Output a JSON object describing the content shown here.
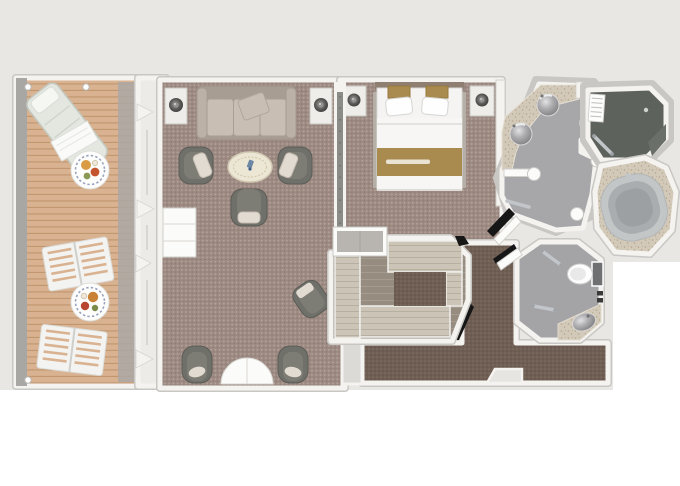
{
  "app": {
    "kind": "suite-floor-plan-rendering",
    "orientation": "top-down"
  },
  "colors": {
    "paper": "#ffffff",
    "bg": "#e8e7e4",
    "wall": "#f4f3f0",
    "wallEdge": "#c8c7c4",
    "deck": "#d9b391",
    "deckLine": "#c0976f",
    "deckRail": "#a9a7a4",
    "glass": "#edebe8",
    "carpet": "#9d8a82",
    "carpetDot": "#b5a49d",
    "carpetDark": "#8b7870",
    "hallCarpet": "#6f5e53",
    "hallDot": "#7f6e62",
    "hallDark": "#5f4f45",
    "woodShelf": "#cbc4b7",
    "woodLine": "#b7afa0",
    "closetFloor": "#968c80",
    "closetFloorLine": "#a59b8e",
    "sofa": "#bcb1a7",
    "sofaDark": "#a89d92",
    "cushion": "#c9beb4",
    "chair": "#70706a",
    "chairDark": "#5c5c56",
    "chairInner": "#7d7d75",
    "pillowLight": "#e2dbd2",
    "tableCream": "#ece6d4",
    "lampDark": "#4c4b49",
    "white": "#fbfbf9",
    "bedWhite": "#f5f4f2",
    "gold": "#aa8b4f",
    "goldLight": "#e9e3d3",
    "nightstand": "#efedea",
    "bathFloor": "#a7a7aa",
    "counter": "#d3c9b9",
    "counterDot": "#b3a68d",
    "sink": "#97979a",
    "showerFloor": "#5e625c",
    "tub": "#c3c6c7",
    "tubInner": "#a9adaf",
    "tubPool": "#9ca0a3",
    "chrome": "#c2c5c9",
    "shadowBlack": "#161616",
    "doorRecess": "#dbdad7",
    "headboard": "#8e7f72",
    "divider": "#8b8b88"
  },
  "rooms": {
    "balcony": {
      "label": "Balcony with teak deck",
      "furniture": [
        "chaise-lounge",
        "breakfast-plate-table",
        "deck-chair",
        "deck-chair",
        "breakfast-plate-table",
        "railing-posts"
      ]
    },
    "living": {
      "label": "Living room",
      "furniture": [
        "sofa",
        "throw-pillow",
        "side-table-lamp",
        "side-table-lamp",
        "armchair",
        "armchair",
        "armchair",
        "coffee-table",
        "writing-desk",
        "desk-chair",
        "demilune-table",
        "tub-chair",
        "tub-chair"
      ]
    },
    "bedroom": {
      "label": "Bedroom",
      "furniture": [
        "double-bed",
        "pillows",
        "bed-runner",
        "nightstand-lamp",
        "nightstand-lamp",
        "vanity-desk"
      ]
    },
    "closet": {
      "label": "Walk-in closet",
      "furniture": [
        "wardrobe-shelves"
      ]
    },
    "hallway": {
      "label": "Entry hallway",
      "furniture": [
        "entry-door-recess"
      ]
    },
    "bathroom": {
      "label": "Master bathroom",
      "furniture": [
        "double-vanity-sinks",
        "door-leaf",
        "grab-bar",
        "columns"
      ]
    },
    "shower": {
      "label": "Walk-in shower",
      "furniture": [
        "shower-mat",
        "shower-door",
        "drain"
      ]
    },
    "bathtub": {
      "label": "Soaking tub",
      "furniture": [
        "oval-tub"
      ]
    },
    "toilet": {
      "label": "Toilet room",
      "furniture": [
        "toilet",
        "washbasin",
        "towel-bar",
        "towel-bar",
        "paper-holder",
        "door-leaf"
      ]
    }
  }
}
